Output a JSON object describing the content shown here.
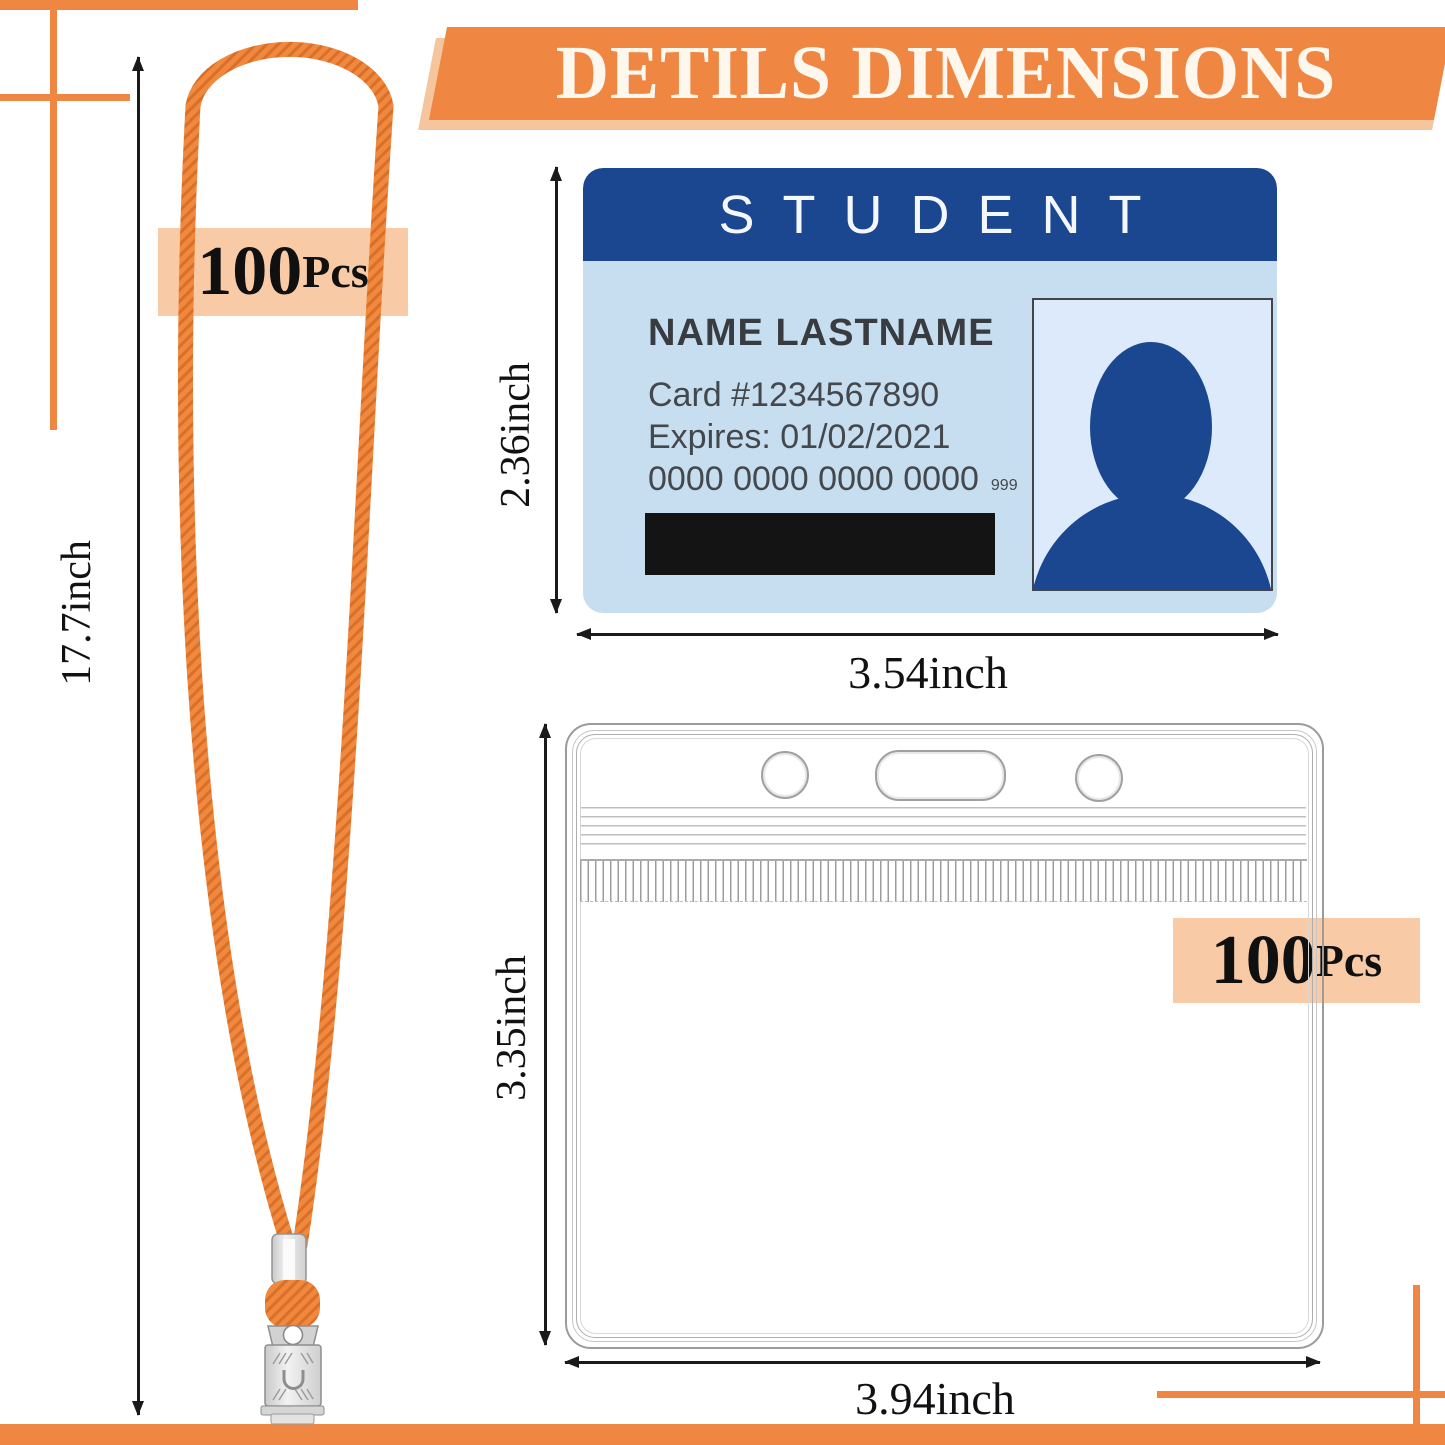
{
  "banner": {
    "title": "DETILS DIMENSIONS"
  },
  "lanyard": {
    "count_big": "100",
    "count_small": "Pcs",
    "length": "17.7inch"
  },
  "card": {
    "header": "STUDENT",
    "name": "NAME LASTNAME",
    "number": "Card #1234567890",
    "expires": "Expires: 01/02/2021",
    "digits": "0000 0000 0000 0000",
    "digits_cvv": "999",
    "height": "2.36inch",
    "width": "3.54inch"
  },
  "holder": {
    "count_big": "100",
    "count_small": "Pcs",
    "height": "3.35inch",
    "width": "3.94inch"
  },
  "colors": {
    "accent": "#EF8742",
    "accent_light": "#F5C69E",
    "badge_bg": "#F8CBA6",
    "strap": "#F0883E",
    "strap_dark": "#D96F28",
    "card_header": "#1B4690",
    "card_body": "#C7DEF1",
    "photo_bg": "#DCEAFB",
    "silhouette": "#1B4690",
    "card_text": "#44484D",
    "dim_line": "#1A1A1A",
    "pouch_line": "#9B9B9B"
  }
}
